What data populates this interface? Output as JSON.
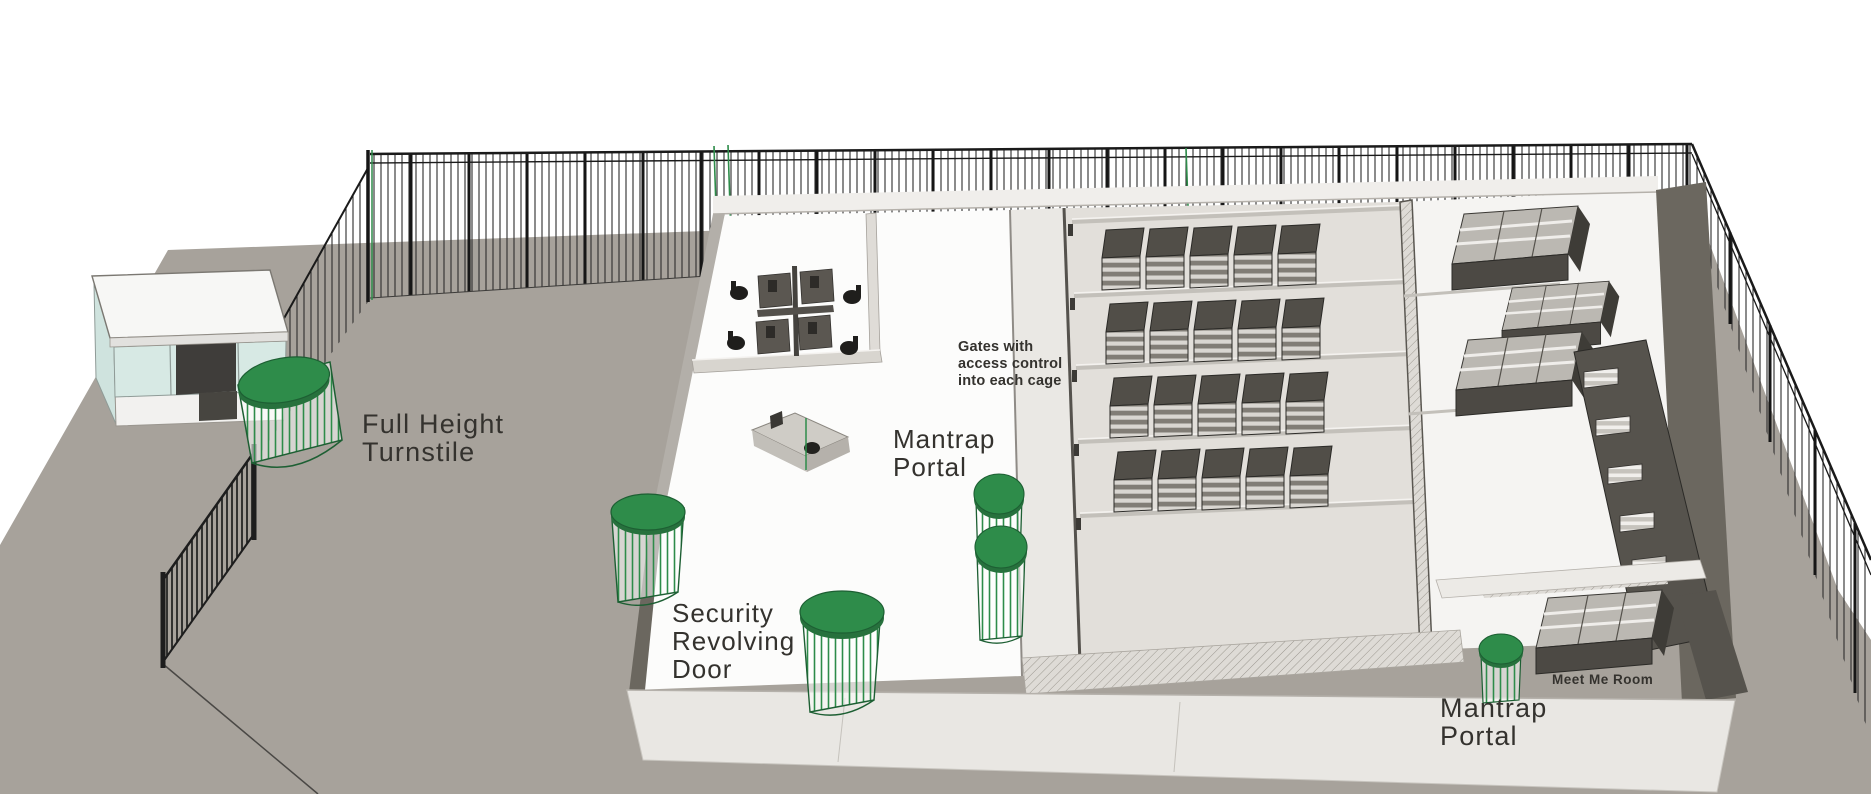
{
  "labels": {
    "full_height_turnstile": {
      "line1": "Full Height",
      "line2": "Turnstile"
    },
    "security_revolving_door": {
      "line1": "Security",
      "line2": "Revolving",
      "line3": "Door"
    },
    "mantrap_portal_entry": {
      "line1": "Mantrap",
      "line2": "Portal"
    },
    "gates_access_control": {
      "line1": "Gates with",
      "line2": "access control",
      "line3": "into each cage"
    },
    "meet_me_room": {
      "text": "Meet Me Room"
    },
    "mantrap_portal_meet_me": {
      "line1": "Mantrap",
      "line2": "Portal"
    }
  },
  "colors": {
    "background": "#ffffff",
    "ground": "#a7a29b",
    "accent_green": "#2e8c4a",
    "accent_green_dark": "#27713d",
    "rack_dark": "#524f49",
    "wall_dark": "#6b675f",
    "floor_white": "#fcfcfb",
    "text": "#34322e"
  }
}
